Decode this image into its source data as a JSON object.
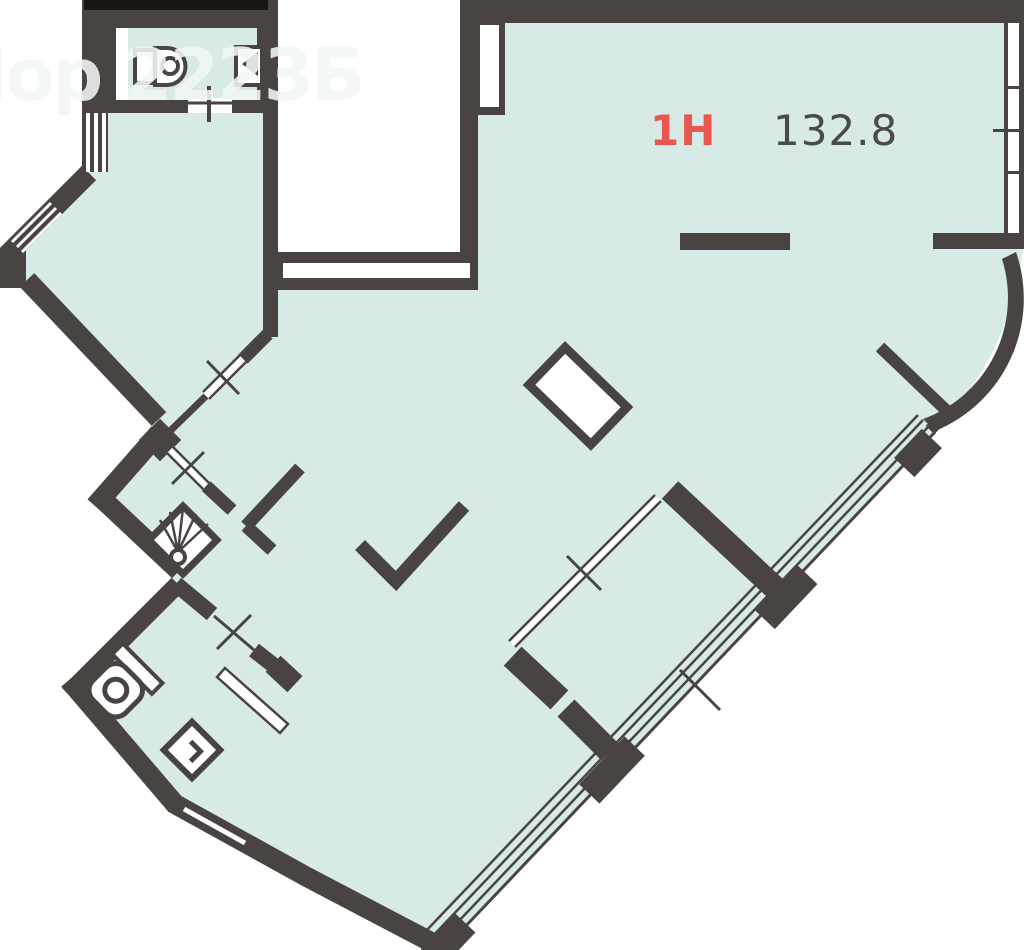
{
  "plan": {
    "unit_label": "1Н",
    "area_value": "132.8",
    "watermark_text": "Нор 2223Б",
    "colors": {
      "background": "#ffffff",
      "floor": "#d7eae6",
      "wall": "#494442",
      "accent_red": "#e8584e",
      "text_dark": "#4a4a4a",
      "watermark": "#f2f6f6",
      "top_bar": "#191715"
    },
    "icons": [
      "sink-icon",
      "electric-panel-icon",
      "fan-icon",
      "toilet-icon",
      "washbasin-icon",
      "ventilation-shaft",
      "window-hatch",
      "cross-marker"
    ]
  }
}
